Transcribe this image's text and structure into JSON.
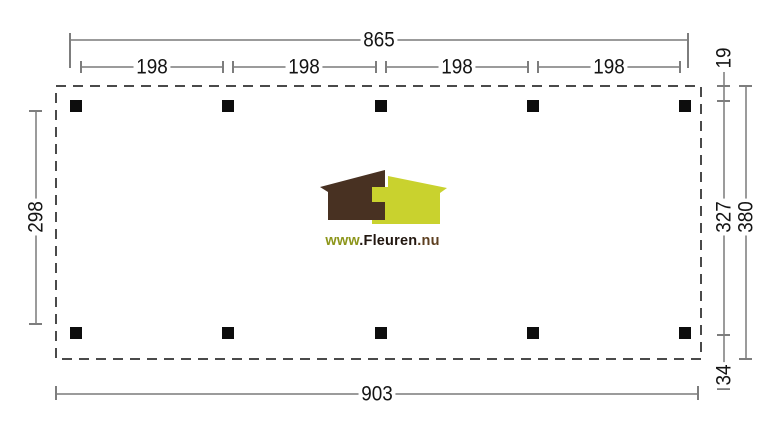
{
  "drawing": {
    "type": "flat-roof canopy plan, top view",
    "dimensions": {
      "top_total": "865",
      "top_segments": [
        "198",
        "198",
        "198",
        "198"
      ],
      "right_top": "19",
      "right_middle": "327",
      "right_total": "380",
      "right_bottom": "34",
      "left_side": "298",
      "bottom_total": "903"
    },
    "posts": {
      "rows": 2,
      "columns": 5,
      "count": 10
    },
    "colors": {
      "dimline": "#9b9b9b",
      "tick": "#7d7d7d",
      "outline": "#4a4a4a",
      "post": "#0d0d0d",
      "text": "#141414"
    }
  },
  "logo": {
    "www": "www",
    "name": ".Fleuren",
    "tld": ".nu",
    "colors": {
      "brown_house": "#483122",
      "green_house": "#c9d22e",
      "www_text": "#8d961b",
      "name_text": "#221710",
      "tld_text": "#5d3f20"
    }
  }
}
